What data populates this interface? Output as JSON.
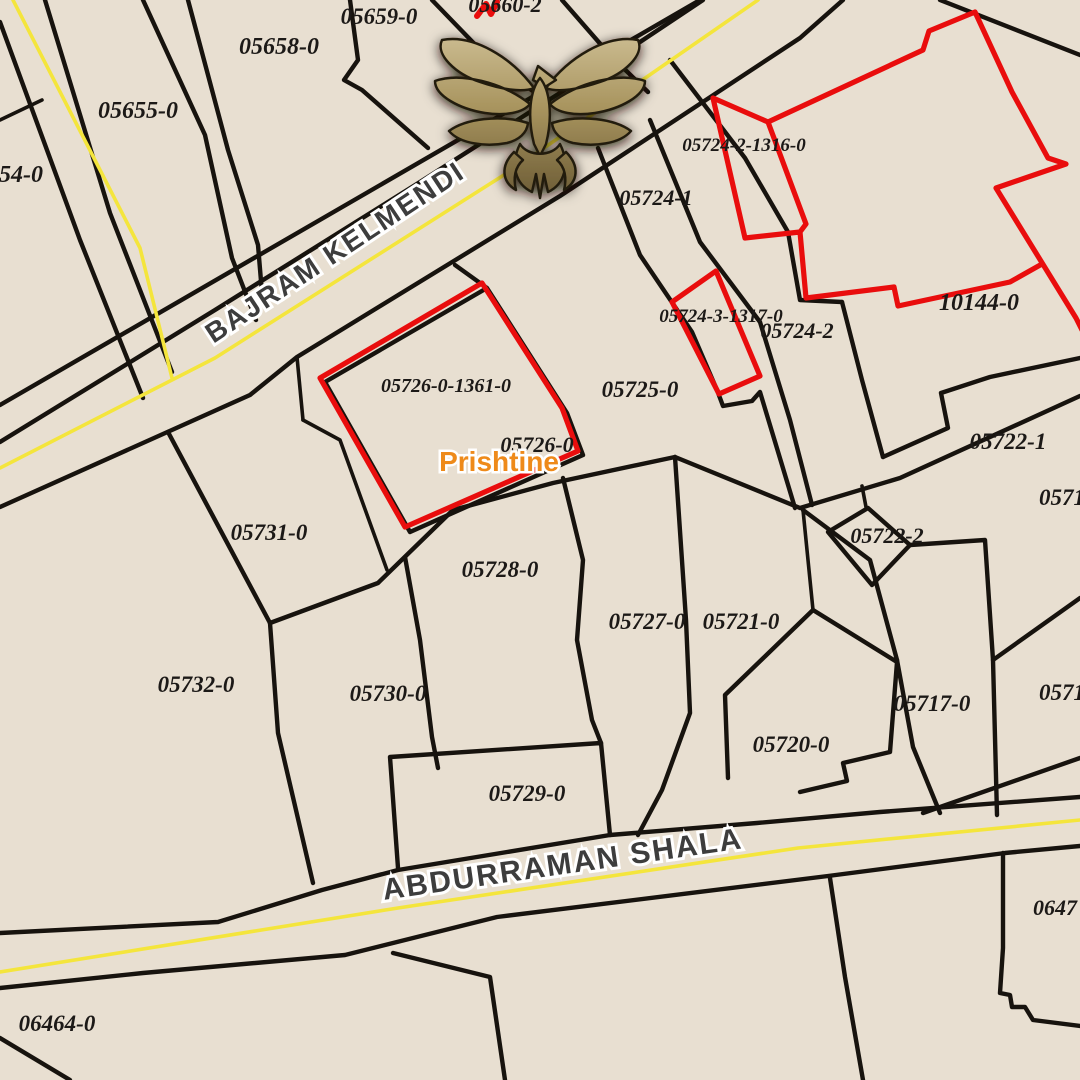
{
  "map": {
    "title": "Cadastral parcel map",
    "place_label": {
      "text": "Prishtine",
      "x": 499,
      "y": 471,
      "fs": 28
    },
    "streets": [
      {
        "name": "BAJRAM KELMENDI",
        "x": 340,
        "y": 260,
        "rot": -33.5,
        "fs": 28
      },
      {
        "name": "ABDURRAMAN SHALA",
        "x": 564,
        "y": 874,
        "rot": -8.2,
        "fs": 30
      }
    ],
    "parcel_labels": [
      {
        "text": "05660-2",
        "x": 505,
        "y": 12,
        "fs": 22
      },
      {
        "text": "05659-0",
        "x": 379,
        "y": 24,
        "fs": 23
      },
      {
        "text": "05658-0",
        "x": 279,
        "y": 54,
        "fs": 24
      },
      {
        "text": "05655-0",
        "x": 138,
        "y": 118,
        "fs": 24
      },
      {
        "text": "54-0",
        "x": 21,
        "y": 182,
        "fs": 24
      },
      {
        "text": "05724-2-1316-0",
        "x": 744,
        "y": 151,
        "fs": 19
      },
      {
        "text": "05724-1",
        "x": 656,
        "y": 205,
        "fs": 22
      },
      {
        "text": "10144-0",
        "x": 979,
        "y": 310,
        "fs": 24
      },
      {
        "text": "05724-3-1317-0",
        "x": 721,
        "y": 322,
        "fs": 19
      },
      {
        "text": "05724-2",
        "x": 797,
        "y": 338,
        "fs": 22
      },
      {
        "text": "05726-0-1361-0",
        "x": 446,
        "y": 392,
        "fs": 20
      },
      {
        "text": "05725-0",
        "x": 640,
        "y": 397,
        "fs": 23
      },
      {
        "text": "05726-0",
        "x": 537,
        "y": 452,
        "fs": 22
      },
      {
        "text": "05722-1",
        "x": 1008,
        "y": 449,
        "fs": 23
      },
      {
        "text": "0571",
        "x": 1062,
        "y": 505,
        "fs": 23
      },
      {
        "text": "05731-0",
        "x": 269,
        "y": 540,
        "fs": 23
      },
      {
        "text": "05722-2",
        "x": 887,
        "y": 543,
        "fs": 22
      },
      {
        "text": "05728-0",
        "x": 500,
        "y": 577,
        "fs": 23
      },
      {
        "text": "05727-0",
        "x": 647,
        "y": 629,
        "fs": 23
      },
      {
        "text": "05721-0",
        "x": 741,
        "y": 629,
        "fs": 23
      },
      {
        "text": "05732-0",
        "x": 196,
        "y": 692,
        "fs": 23
      },
      {
        "text": "05730-0",
        "x": 388,
        "y": 701,
        "fs": 23
      },
      {
        "text": "05717-0",
        "x": 932,
        "y": 711,
        "fs": 23
      },
      {
        "text": "0571",
        "x": 1062,
        "y": 700,
        "fs": 23
      },
      {
        "text": "05720-0",
        "x": 791,
        "y": 752,
        "fs": 23
      },
      {
        "text": "05729-0",
        "x": 527,
        "y": 801,
        "fs": 23
      },
      {
        "text": "0647",
        "x": 1055,
        "y": 915,
        "fs": 22
      },
      {
        "text": "06464-0",
        "x": 57,
        "y": 1031,
        "fs": 23
      }
    ],
    "highlighted_parcels": [
      "05726-0-1361-0",
      "05724-2-1316-0",
      "05724-3-1317-0",
      "10144-0"
    ],
    "logo": "eagle-logo",
    "colors": {
      "background": "#e8dfd1",
      "boundary": "#17130e",
      "road_center": "#f4e53c",
      "highlight": "#e90d0d",
      "label": "#1c1917",
      "street_fill": "#3d3d3d",
      "street_halo": "#ffffff",
      "place": "#ee8a1a",
      "logo_gold": "#a5925f"
    }
  }
}
